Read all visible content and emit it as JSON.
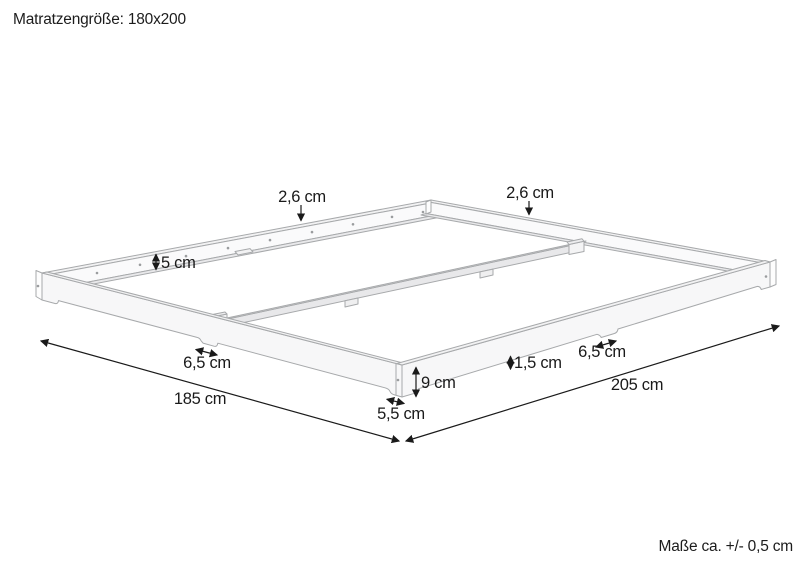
{
  "page": {
    "background": "#ffffff",
    "title": "Matratzengröße: 180x200",
    "footnote": "Maße ca. +/- 0,5 cm"
  },
  "diagram": {
    "kind": "isometric technical dimension drawing",
    "subject": "bed slat frame base for a 180x200 mattress",
    "colors": {
      "frame_line": "#a7a9ab",
      "annotation": "#1a1a1a",
      "face_top": "#f2f2f3",
      "face_outer": "#f7f7f8",
      "face_inner": "#fafafb",
      "face_ledge": "#e9e9eb"
    },
    "dimensions": {
      "top_edge_back_left": "2,6 cm",
      "top_edge_back_right": "2,6 cm",
      "inner_rail_height": "5 cm",
      "mid_foot_width_left": "6,5 cm",
      "mid_foot_width_right": "6,5 cm",
      "frame_height": "9 cm",
      "bottom_edge_clearance": "1,5 cm",
      "corner_foot_width": "5,5 cm",
      "outer_width": "185 cm",
      "outer_length": "205 cm"
    }
  }
}
